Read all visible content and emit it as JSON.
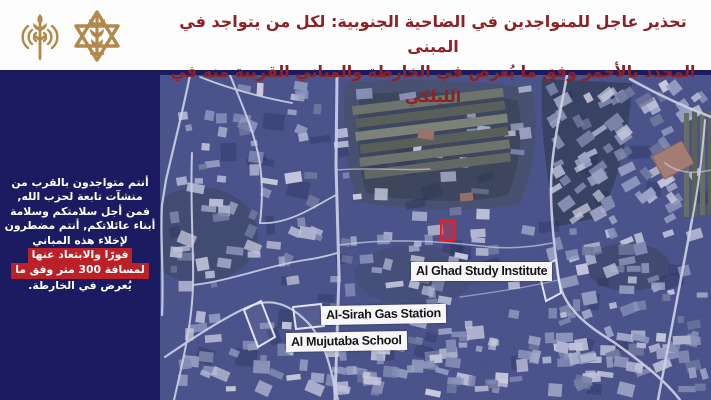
{
  "header": {
    "title_line1": "تحذير عاجل للمتواجدين في الضاحية الجنوبية: لكل من يتواجد في المبنى",
    "title_line2": "المحدد بالأحمر وفق ما يُعرض في الخارطة والمباني القريبة منه في الليلكي",
    "icons": [
      {
        "name": "broadcast-antenna-icon"
      },
      {
        "name": "idf-emblem-icon"
      }
    ]
  },
  "sidebar": {
    "lines": [
      {
        "text": "أنتم متواجدون بالقرب من",
        "highlight": false
      },
      {
        "text": "منشآت تابعة لحزب الله,",
        "highlight": false
      },
      {
        "text": "فمن أجل سلامتكم وسلامة",
        "highlight": false
      },
      {
        "text": "أبناء عائلاتكم, أنتم مضطرون",
        "highlight": false
      },
      {
        "text": "لإخلاء هذه المباني",
        "highlight": false
      },
      {
        "text": "فورًا والابتعاد عنها",
        "highlight": true
      },
      {
        "text": "لمسافة 300 متر وفق ما",
        "highlight": true
      },
      {
        "text": "يُعرض في الخارطة.",
        "highlight": false
      }
    ]
  },
  "map": {
    "type": "satellite",
    "labels": [
      {
        "text": "Al Ghad Study Institute"
      },
      {
        "text": "Al-Sirah Gas Station"
      },
      {
        "text": "Al Mujutaba School"
      }
    ],
    "target_marker": "red-rectangle-marked-building"
  },
  "colors": {
    "background_navy": "#1a1b61",
    "header_background": "#fdfdfd",
    "header_text_red": "#8e2125",
    "sidebar_highlight_red": "#bb2127",
    "target_red": "#f21a1a",
    "emblem_gold": "#b1894a",
    "label_background": "#f7f7f7"
  }
}
